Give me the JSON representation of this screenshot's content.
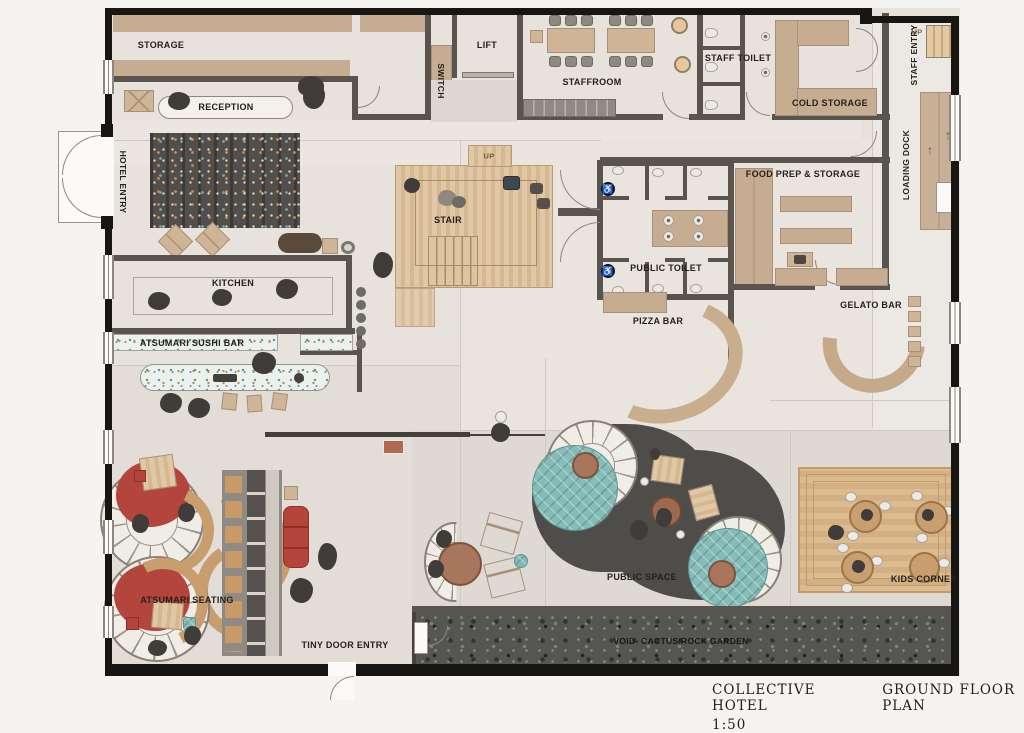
{
  "title": {
    "project": "COLLECTIVE HOTEL",
    "drawing": "GROUND FLOOR PLAN",
    "scale": "1:50"
  },
  "rooms": {
    "storage": "STORAGE",
    "reception": "RECEPTION",
    "hotel_entry": "HOTEL ENTRY",
    "lift": "LIFT",
    "switch": "SWITCH",
    "staffroom": "STAFFROOM",
    "staff_toilet": "STAFF TOILET",
    "cold_storage": "COLD STORAGE",
    "staff_entry": "STAFF ENTRY",
    "staff_stair_up": "UP",
    "loading_dock": "LOADING DOCK",
    "food_prep": "FOOD PREP & STORAGE",
    "public_toilet": "PUBLIC TOILET",
    "stair": "STAIR",
    "stair_up": "UP",
    "kitchen": "KITCHEN",
    "sushi_bar": "ATSUMARI SUSHI BAR",
    "pizza_bar": "PIZZA BAR",
    "gelato_bar": "GELATO BAR",
    "atsumari_seating": "ATSUMARI SEATING",
    "tiny_door": "TINY DOOR ENTRY",
    "public_space": "PUBLIC SPACE",
    "kids_corner": "KIDS CORNER",
    "void_garden": "VOID- CACTUS/ROCK GARDEN"
  },
  "icons": {
    "accessible": "♿",
    "up_arrow": "↑"
  },
  "colors": {
    "accent_red": "#b4453c",
    "teal": "#85bcb7",
    "wood": "#d5b890",
    "wall_dark": "#5a544e",
    "wall_black": "#181613",
    "floor": "#e7e2dc",
    "public_space_dark": "#4f4d4a"
  }
}
